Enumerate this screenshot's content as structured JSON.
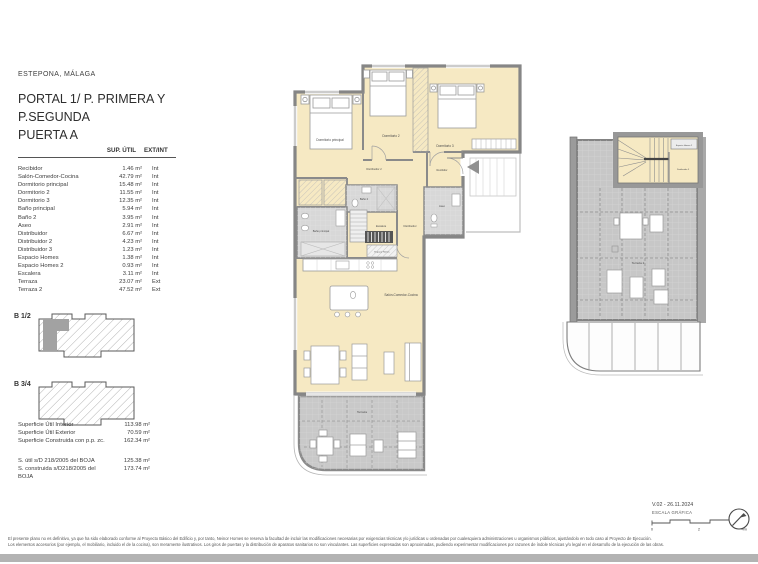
{
  "header": {
    "location": "ESTEPONA, MÁLAGA",
    "title_lines": [
      "PORTAL 1/ P. PRIMERA Y",
      "P.SEGUNDA",
      "PUERTA A"
    ]
  },
  "area_table": {
    "headers": {
      "sup": "SUP. ÚTIL",
      "ext": "EXT/INT"
    },
    "rows": [
      {
        "name": "Recibidor",
        "area": "1.46 m²",
        "loc": "Int"
      },
      {
        "name": "Salón-Comedor-Cocina",
        "area": "42.79 m²",
        "loc": "Int"
      },
      {
        "name": "Dormitorio principal",
        "area": "15.48 m²",
        "loc": "Int"
      },
      {
        "name": "Dormitorio 2",
        "area": "11.55 m²",
        "loc": "Int"
      },
      {
        "name": "Dormitorio 3",
        "area": "12.35 m²",
        "loc": "Int"
      },
      {
        "name": "Baño principal",
        "area": "5.94 m²",
        "loc": "Int"
      },
      {
        "name": "Baño 2",
        "area": "3.95 m²",
        "loc": "Int"
      },
      {
        "name": "Aseo",
        "area": "2.91 m²",
        "loc": "Int"
      },
      {
        "name": "Distribuidor",
        "area": "6.67 m²",
        "loc": "Int"
      },
      {
        "name": "Distribuidor 2",
        "area": "4.23 m²",
        "loc": "Int"
      },
      {
        "name": "Distribuidor 3",
        "area": "1.23 m²",
        "loc": "Int"
      },
      {
        "name": "Espacio Homes",
        "area": "1.38 m²",
        "loc": "Int"
      },
      {
        "name": "Espacio Homes 2",
        "area": "0.93 m²",
        "loc": "Int"
      },
      {
        "name": "Escalera",
        "area": "3.11 m²",
        "loc": "Int"
      },
      {
        "name": "Terraza",
        "area": "23.07 m²",
        "loc": "Ext"
      },
      {
        "name": "Terraza 2",
        "area": "47.52 m²",
        "loc": "Ext"
      }
    ]
  },
  "key_plans": {
    "b12": "B 1/2",
    "b34": "B 3/4"
  },
  "totals": [
    {
      "name": "Superficie Útil Interior",
      "value": "113.98 m²"
    },
    {
      "name": "Superficie Útil Exterior",
      "value": "70.59 m²"
    },
    {
      "name": "Superficie Construida con p.p. zc.",
      "value": "162.34 m²"
    }
  ],
  "boja_totals": [
    {
      "name": "S. útil s/D 218/2005 del BOJA",
      "value": "125.38 m²"
    },
    {
      "name": "S. construida s/D218/2005 del BOJA",
      "value": "173.74 m²"
    }
  ],
  "plan_labels": {
    "dormitorio_principal": "Dormitorio principal",
    "dormitorio_2": "Dormitorio 2",
    "dormitorio_3": "Dormitorio 3",
    "distribuidor_2": "Distribuidor 2",
    "recibidor": "Recibidor",
    "bano_2": "Baño 2",
    "aseo": "Aseo",
    "bano_principal": "Baño principal",
    "escalera": "Escalera",
    "distribuidor": "Distribuidor",
    "espacio_homes": "Espacio Homes",
    "salon": "Salón-Comedor-Cocina",
    "terraza": "Terraza",
    "espacio_homes_2": "Espacio Homes 2",
    "distribuidor_3": "Distribuidor 3",
    "terraza_2": "Terraza 2"
  },
  "title_block": {
    "version": "V.02 - 26.11.2024",
    "scale_label": "ESCALA GRÁFICA",
    "scale_ticks": [
      "0",
      "2",
      "4m"
    ]
  },
  "footer": {
    "line1": "El presente plano no es definitivo, ya que ha sido elaborado conforme al Proyecto Básico del Edificio y, por tanto, Neinor Homes se reserva la facultad de incluir las modificaciones necesarias por exigencias técnicas y/o jurídicas u ordenadas por cualesquiera administraciones u organismos públicos, ajustándolo en todo caso al Proyecto de Ejecución.",
    "line2": "Los elementos accesorios (por ejemplo, el mobiliario, incluido el de la cocina), son meramente ilustrativos. Los giros de puertas y la distribución de aparatos sanitarios no son vinculantes. Las superficies expresadas son aproximadas, pudiendo experimentar modificaciones por razones de índole técnicas y/o legal en el desarrollo de la ejecución de las obras."
  },
  "colors": {
    "room_fill": "#f6e9c3",
    "wall_gray": "#868686",
    "tile_gray": "#d8d8d8",
    "terrace_gray": "#c9c9c9",
    "footer_bar": "#b3b3b3"
  }
}
